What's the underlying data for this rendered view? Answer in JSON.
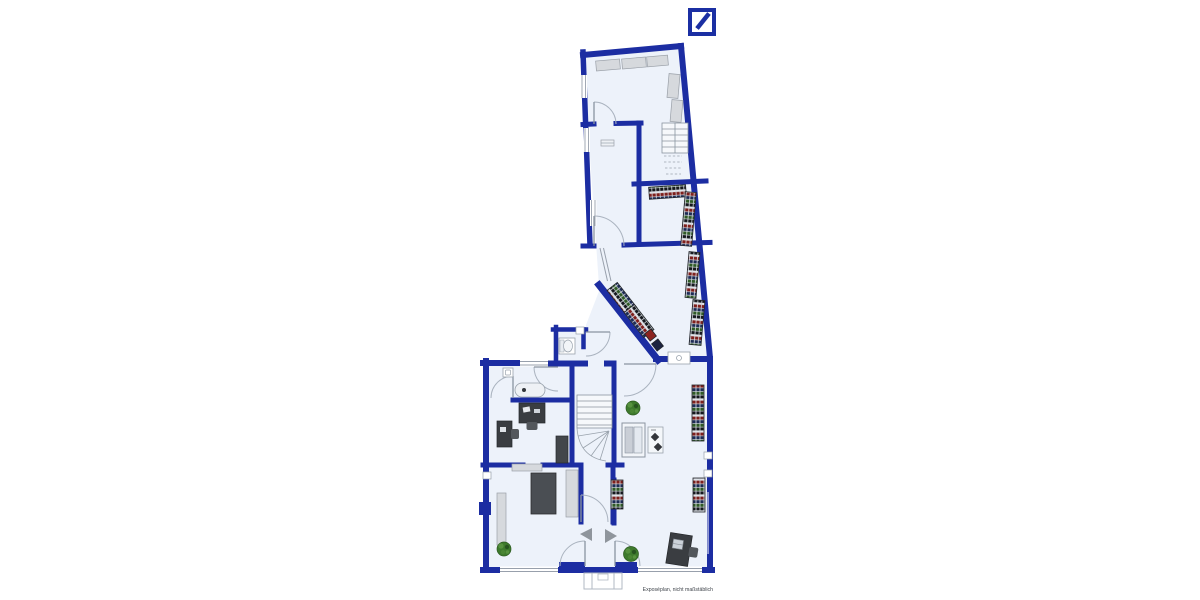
{
  "page": {
    "background": "#ffffff",
    "caption": "Exposéplan, nicht maßstäblich"
  },
  "branding": {
    "logo": "Deutsche Bank",
    "logo_color": "#1b2fa3"
  },
  "palette": {
    "wall_blue": "#1c2da2",
    "floor": "#edf2fa",
    "furniture_gray": "#d6d9dd",
    "desk_dark": "#3a3d41",
    "shelf_goods_colors": [
      "#7e1f1c",
      "#1d2b55",
      "#2f5a26",
      "#14171c"
    ],
    "plant_green": "#3e7a2d",
    "thin_line_gray": "#9aa3ad",
    "arrow_gray": "#8f959c"
  },
  "floor_plan": {
    "kind": "ground-floor plan of a bank/retail branch",
    "shape": "lower rectangular building with slanted upper wing",
    "inventory": {
      "staircases": 2,
      "entrance_double_doors": 2,
      "direction_arrows": 2,
      "shelf_units": 9,
      "goods_carts": 2,
      "desks_with_chairs": 3,
      "meeting_table": 1,
      "cabinets": 1,
      "wall_counters": 8,
      "plants": 3,
      "display_case": 1,
      "small_stand": 1,
      "wc_toilet": 1,
      "sinks": 2,
      "reception_desk": 1,
      "door_arcs": 10,
      "windows": 8
    }
  }
}
